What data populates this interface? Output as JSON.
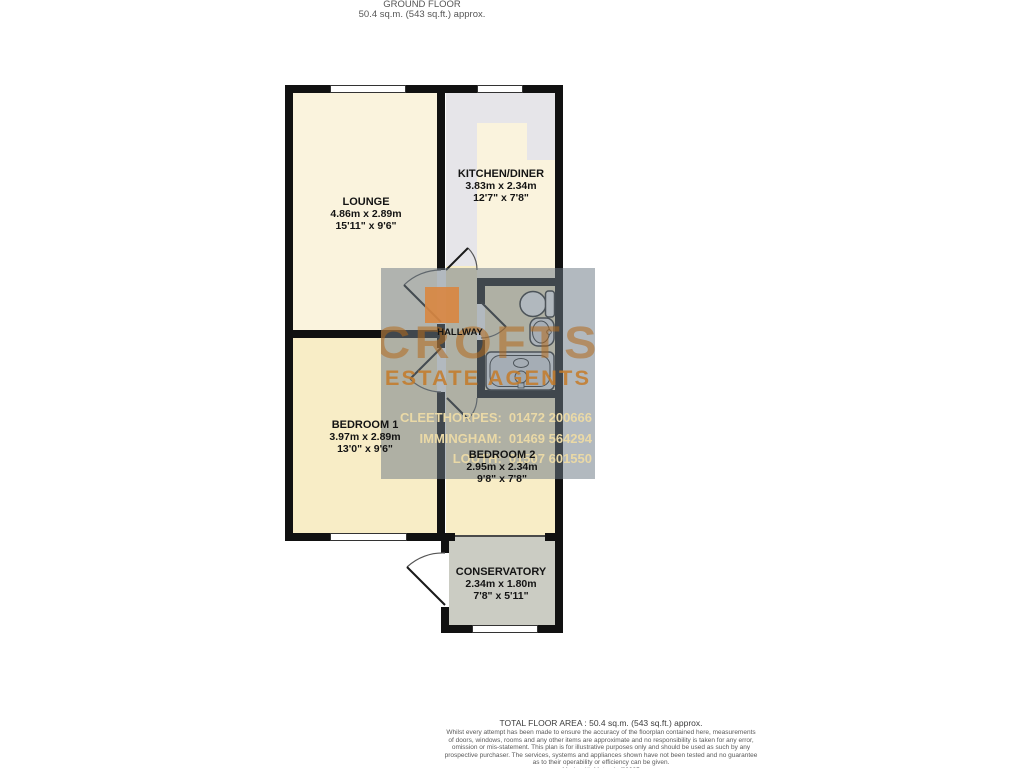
{
  "plan_title": {
    "floor": "GROUND FLOOR",
    "area": "50.4 sq.m. (543 sq.ft.) approx."
  },
  "rooms": [
    {
      "name": "LOUNGE",
      "metric": "4.86m x 2.89m",
      "imperial": "15'11\" x 9'6\""
    },
    {
      "name": "KITCHEN/DINER",
      "metric": "3.83m x 2.34m",
      "imperial": "12'7\" x 7'8\""
    },
    {
      "name": "HALLWAY",
      "metric": "",
      "imperial": ""
    },
    {
      "name": "BEDROOM 1",
      "metric": "3.97m x 2.89m",
      "imperial": "13'0\" x 9'6\""
    },
    {
      "name": "BEDROOM 2",
      "metric": "2.95m x 2.34m",
      "imperial": "9'8\" x 7'8\""
    },
    {
      "name": "CONSERVATORY",
      "metric": "2.34m x 1.80m",
      "imperial": "7'8\" x 5'11\""
    }
  ],
  "watermark": {
    "brand_top": "CROFTS",
    "brand_bottom": "ESTATE AGENTS",
    "offices": [
      {
        "label": "CLEETHORPES:",
        "phone": "01472 200666"
      },
      {
        "label": "IMMINGHAM:",
        "phone": "01469 564294"
      },
      {
        "label": "LOUTH:",
        "phone": "01507 601550"
      }
    ],
    "colors": {
      "overlay": "#6c7885",
      "accent_orange": "#d08038",
      "contact_text": "#ead9a6"
    }
  },
  "footer": {
    "total_area": "TOTAL FLOOR AREA : 50.4 sq.m. (543 sq.ft.) approx.",
    "disclaimer_lines": [
      "Whilst every attempt has been made to ensure the accuracy of the floorplan contained here, measurements",
      "of doors, windows, rooms and any other items are approximate and no responsibility is taken for any error,",
      "omission or mis-statement. This plan is for illustrative purposes only and should be used as such by any",
      "prospective purchaser. The services, systems and appliances shown have not been tested and no guarantee",
      "as to their operability or efficiency can be given.",
      "Made with Metropix ©2025"
    ]
  }
}
